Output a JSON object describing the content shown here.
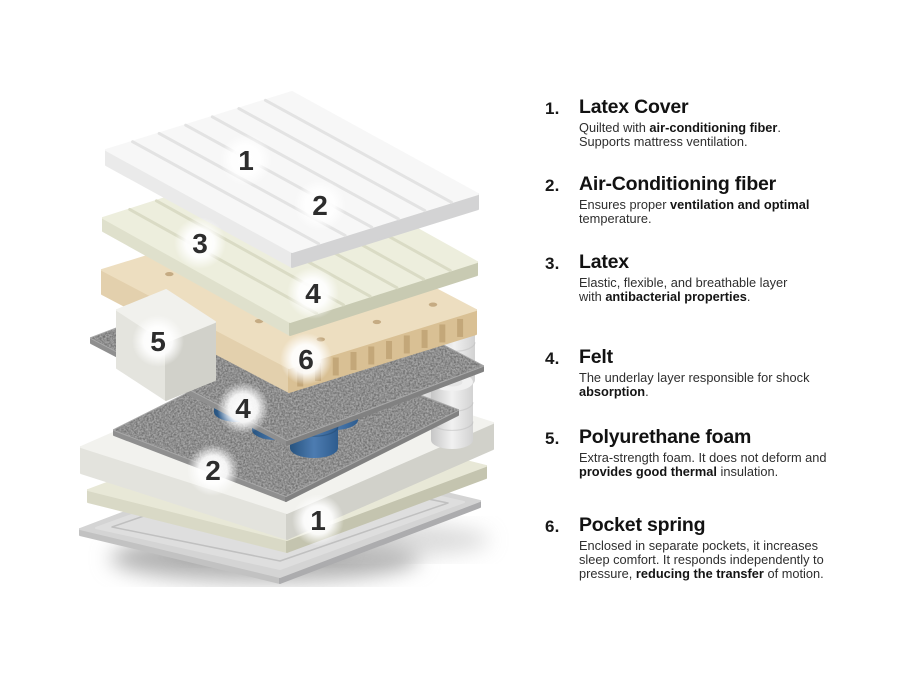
{
  "legend": {
    "items": [
      {
        "num": "1.",
        "title": "Latex Cover",
        "desc": "Quilted with **air-conditioning fiber**.\nSupports mattress ventilation."
      },
      {
        "num": "2.",
        "title": "Air-Conditioning fiber",
        "desc": "Ensures proper **ventilation and optimal** temperature."
      },
      {
        "num": "3.",
        "title": "Latex",
        "desc": "Elastic, flexible, and breathable layer\nwith **antibacterial properties**."
      },
      {
        "num": "4.",
        "title": "Felt",
        "desc": "The underlay layer responsible for shock **absorption**."
      },
      {
        "num": "5.",
        "title": "Polyurethane foam",
        "desc": "Extra-strength foam. It does not deform and\n**provides good thermal** insulation."
      },
      {
        "num": "6.",
        "title": "Pocket spring",
        "desc": "Enclosed in separate pockets, it increases\nsleep comfort. It responds independently to\npressure, **reducing the transfer** of motion."
      }
    ]
  },
  "illustration": {
    "labels": [
      {
        "n": "1",
        "x": 246,
        "y": 160
      },
      {
        "n": "2",
        "x": 320,
        "y": 205
      },
      {
        "n": "3",
        "x": 200,
        "y": 243
      },
      {
        "n": "4",
        "x": 313,
        "y": 293
      },
      {
        "n": "5",
        "x": 158,
        "y": 341
      },
      {
        "n": "6",
        "x": 306,
        "y": 359
      },
      {
        "n": "4",
        "x": 243,
        "y": 408
      },
      {
        "n": "2",
        "x": 213,
        "y": 470
      },
      {
        "n": "1",
        "x": 318,
        "y": 520
      }
    ],
    "colors": {
      "label": "#2d2d2d",
      "coverTop": "#f7f7f7",
      "coverLeft": "#eaeaea",
      "coverRight": "#d3d3d4",
      "coverLine": "#e2e2e2",
      "fiberTop": "#edeedd",
      "fiberLeft": "#dfe0cc",
      "fiberRight": "#c8cab2",
      "fiberLine": "#d9dbc4",
      "latexTop": "#eddec0",
      "latexLeft": "#e3d0ad",
      "latexRight": "#d9c094",
      "latexGroove": "#c0a375",
      "latexHole": "#b3966a",
      "feltTop": "#a9a9a9",
      "feltLeft": "#8f8f8f",
      "feltRight": "#818181",
      "foamTop": "#f2f2ee",
      "foamLeft": "#e3e3dd",
      "foamRight": "#d1d1ca",
      "creamTop": "#e8e8d7",
      "creamLeft": "#d9d9c6",
      "creamRight": "#c4c4af",
      "baseTop": "#d4d4d4",
      "baseInner": "#dedede",
      "baseRim": "#c0c0c0",
      "baseLeft": "#c2c2c2",
      "baseRight": "#acacae",
      "blockTop": "#f1f1ed",
      "blockLeft": "#e4e4de",
      "blockRight": "#d1d1ca",
      "springBlueTop": "#5d89bc",
      "springBlueInner": "#416f9f",
      "springBlueBody": [
        "#27537f",
        "#4d7cb1",
        "#2e5c8e"
      ],
      "springBlueSeam": "#24496f",
      "springWhiteTop": "#f0f0f0",
      "springWhiteInner": "#dcdcdc",
      "springWhiteBody": [
        "#c6c6c6",
        "#f1f1f1",
        "#d2d2d2"
      ],
      "springWhiteSeam": "#bdbdbd",
      "shadowDark": "#2b3a4d",
      "groundShadow": "#b3b3b3"
    }
  }
}
